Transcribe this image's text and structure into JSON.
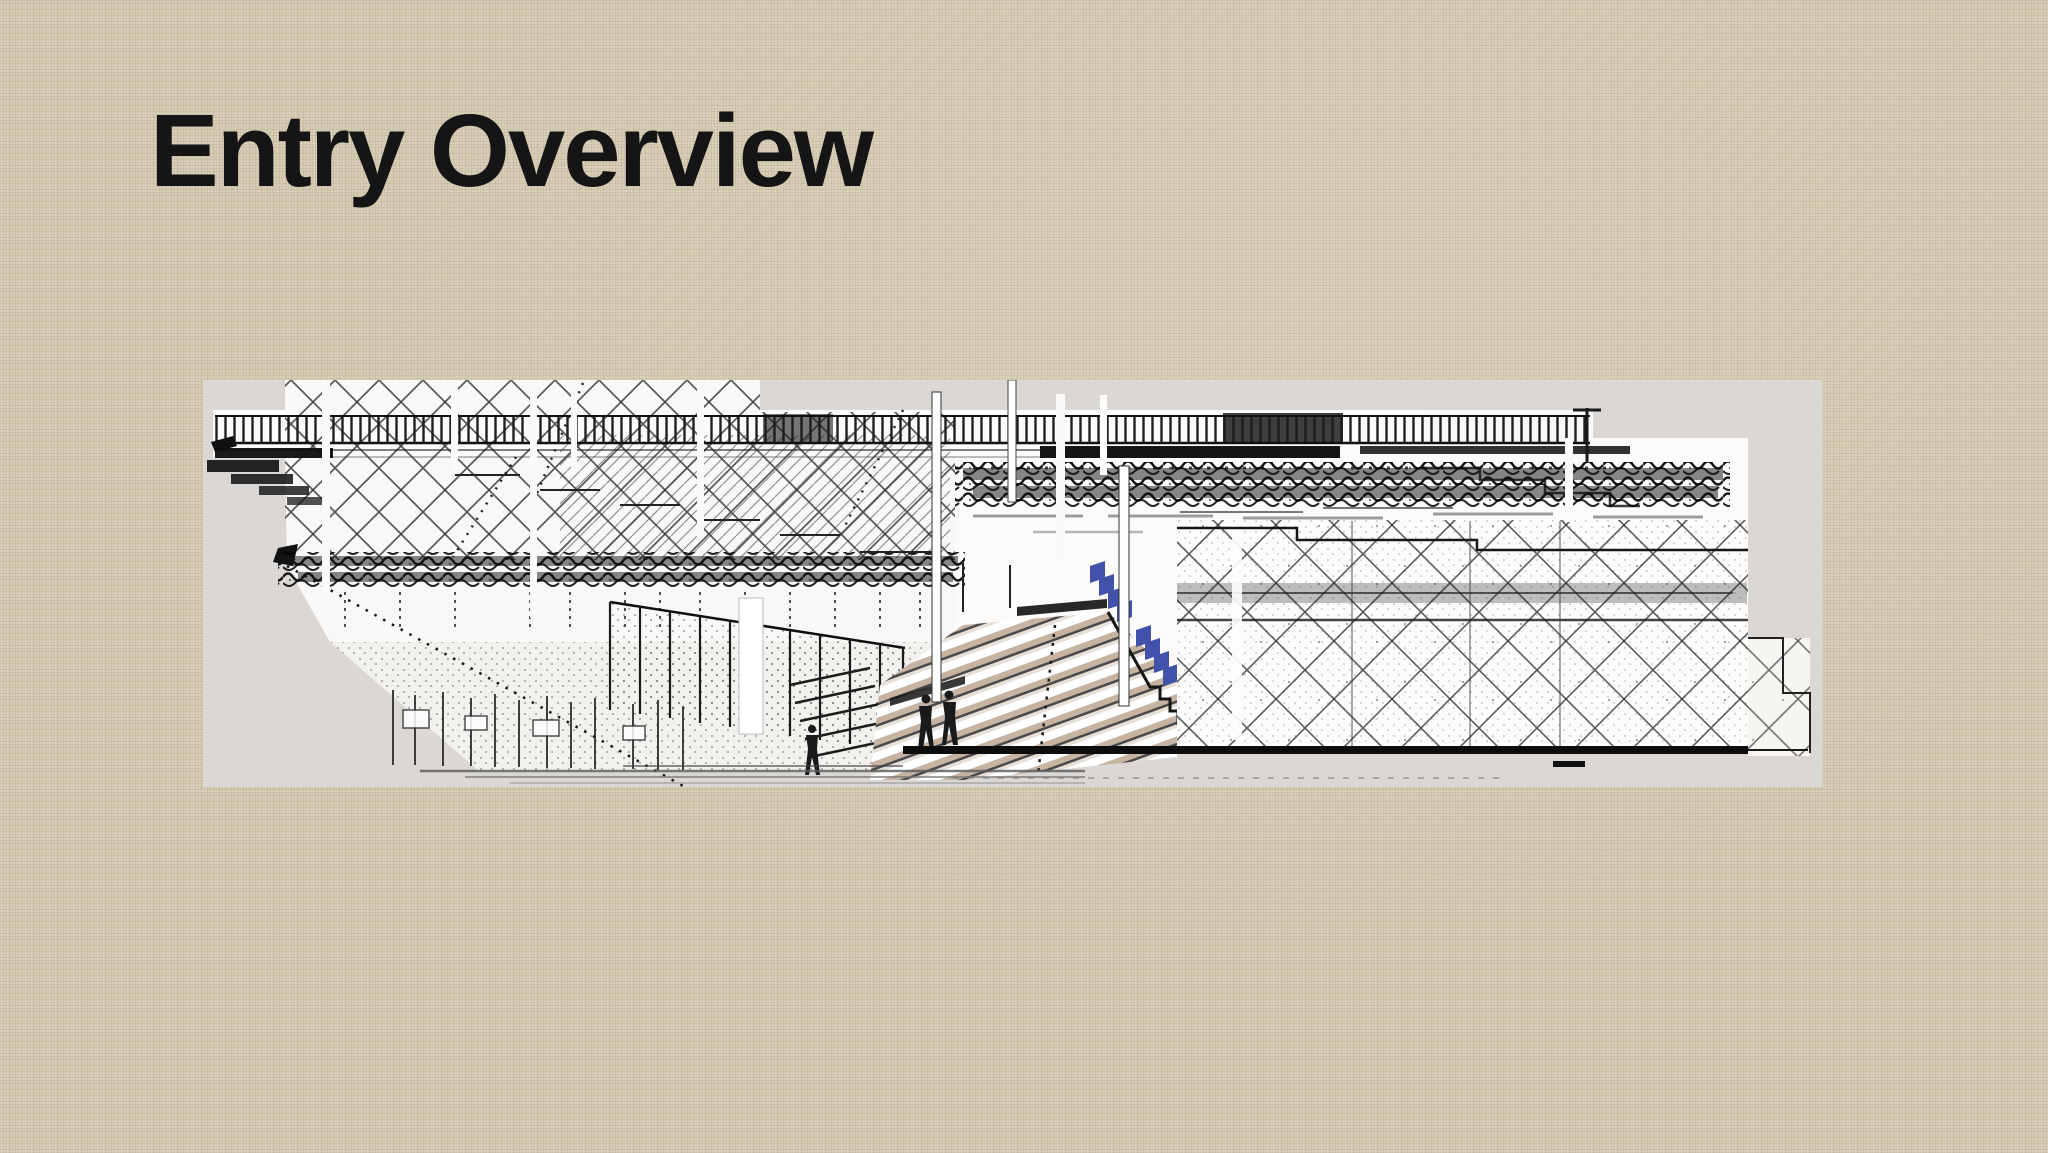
{
  "slide": {
    "title": "Entry Overview",
    "title_color": "#151515",
    "background_color": "#d7ccb3",
    "figure": {
      "name": "entry-architectural-rendering",
      "description": "Black-and-white architectural elevation sketch of an entry plaza: long balustrade railing, crosshatched lattice walls, dark hedge band, chain-link fence, perspective staircase with tan treads, blue stair accents, and three pedestrian silhouettes",
      "canvas_color": "#dad7d4",
      "ink_color": "#1a1a1a",
      "accent_blue": "#4251aa",
      "tread_tan": "#c6b3a2",
      "paper_white": "#faf9f7"
    }
  }
}
